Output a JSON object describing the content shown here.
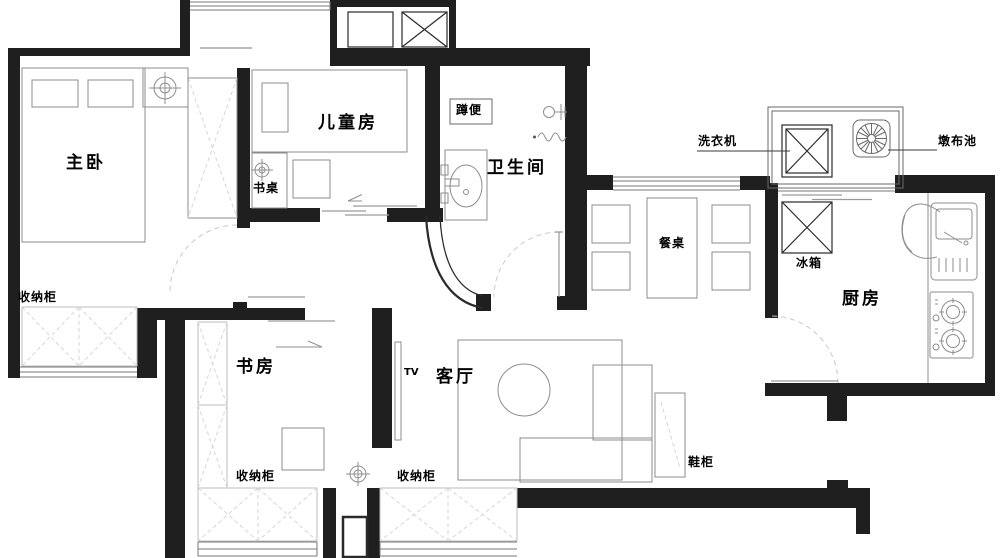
{
  "title": "三室两厅户型平面图",
  "labels": {
    "master_bedroom": "主卧",
    "children_room": "儿童房",
    "bathroom": "卫生间",
    "study": "书房",
    "living_room": "客厅",
    "kitchen": "厨房",
    "dining_table": "餐桌",
    "washing_machine": "洗衣机",
    "mop_pool": "墩布池",
    "fridge": "冰箱",
    "squat_toilet": "蹲便",
    "desk": "书桌",
    "storage_master": "收纳柜",
    "storage_study": "收纳柜",
    "storage_living": "收纳柜",
    "tv": "TV",
    "shoe_cabinet": "鞋柜"
  },
  "icons": {
    "ceiling_light": "circle-crosshair ceiling lamp symbol",
    "shower": "shower-head symbol",
    "drain": "wavy drain line",
    "shaft": "crossed duct/elevator shaft box",
    "mop_pool": "radial fan mop basin symbol"
  },
  "colors": {
    "wall": "#1f1f1f",
    "furniture": "#8c8c8c",
    "cabinet": "#d6d6d6",
    "door": "#c9c9c9",
    "win": "#777777",
    "line": "#555555",
    "bg": "#ffffff",
    "label": "#000000"
  }
}
